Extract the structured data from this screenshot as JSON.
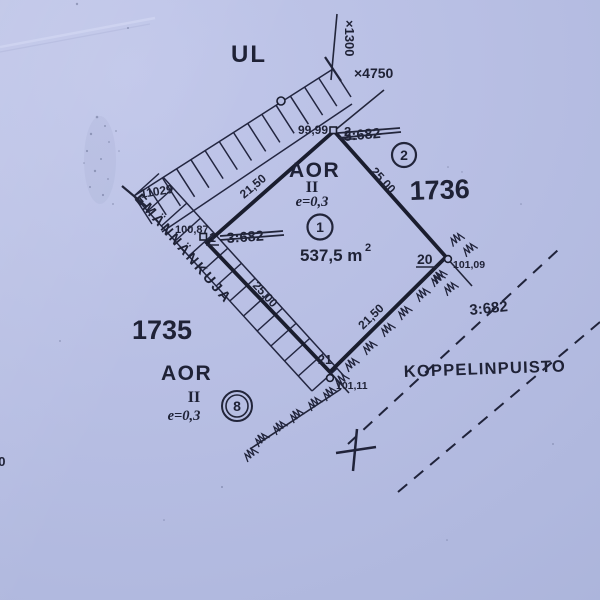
{
  "map": {
    "street_sign": "UL",
    "grid": {
      "coord_vertical": "×1300",
      "coord_horizontal": "×4750"
    },
    "corner_point_number": "11029",
    "street_name": "EMÄNNÄNKUJA",
    "park_name": "KOPPELINPUISTO",
    "blocks": {
      "left": "1735",
      "right": "1736"
    },
    "parcel_refs": {
      "top_struck": "3:682",
      "left_struck": "3:682",
      "right": "3:682"
    },
    "plot_area": {
      "value": "537,5 m",
      "exponent": "2"
    },
    "zones": {
      "plot1": {
        "code": "AOR",
        "storeys": "II",
        "efficiency": "e=0,3",
        "number": "1"
      },
      "plot8": {
        "code": "AOR",
        "storeys": "II",
        "efficiency": "e=0,3",
        "number": "8"
      },
      "plot2_number": "2"
    },
    "points": {
      "p2": {
        "number": "2",
        "elevation": "99,99"
      },
      "p1": {
        "number": "1",
        "elevation": "100,87"
      },
      "p20": {
        "number": "20",
        "elevation": "101,09"
      },
      "p21": {
        "number": "21",
        "elevation": "101,11"
      }
    },
    "dimensions": {
      "edge_1_2": "21,50",
      "edge_2_20": "25.00",
      "edge_1_21": "25.00",
      "edge_21_20": "21,50"
    },
    "edge_partial_number": "00",
    "colors": {
      "paper": "#b7bee3",
      "ink": "#22253a"
    }
  }
}
